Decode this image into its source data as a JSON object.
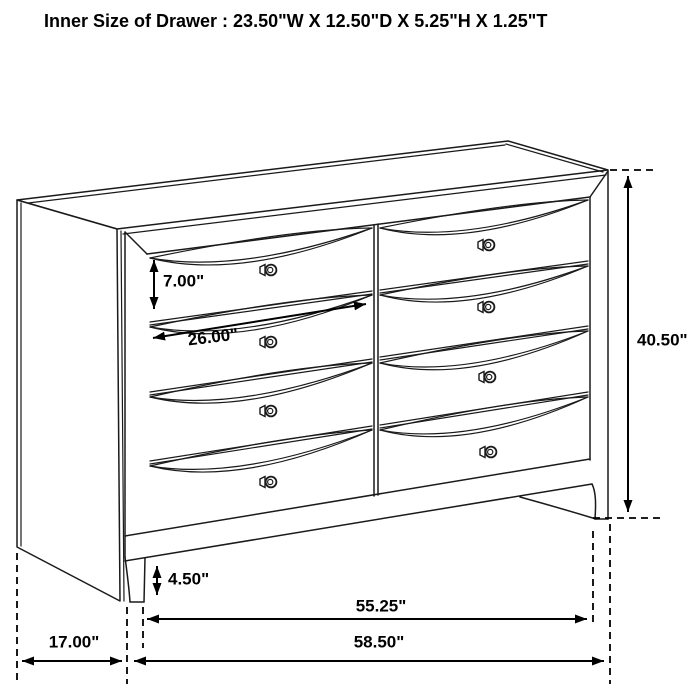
{
  "title": "Inner Size of Drawer : 23.50\"W X 12.50\"D X 5.25\"H X 1.25\"T",
  "diagram": {
    "subject": "eight-drawer dresser technical line drawing",
    "drawer_count": 8,
    "dimensions": {
      "drawer_height": "7.00\"",
      "drawer_width": "26.00\"",
      "overall_height": "40.50\"",
      "foot_height": "4.50\"",
      "base_width": "55.25\"",
      "overall_width": "58.50\"",
      "depth": "17.00\""
    },
    "colors": {
      "line": "#1a1a1a",
      "background": "#ffffff",
      "text": "#000000"
    }
  }
}
